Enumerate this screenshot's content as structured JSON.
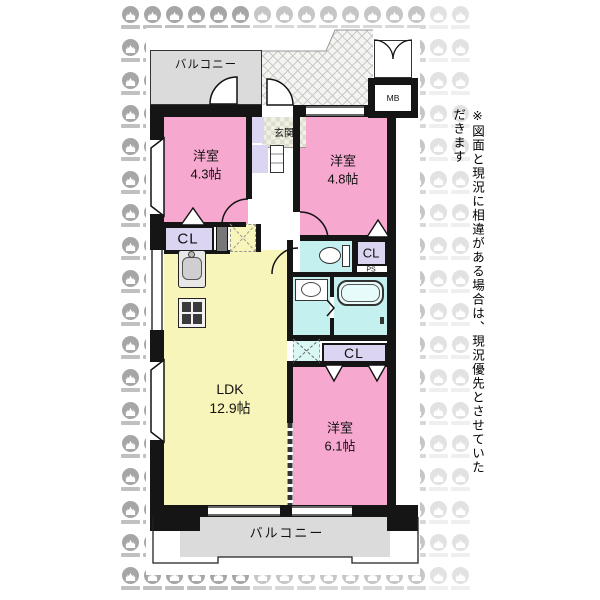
{
  "plan": {
    "balcony_top": "バルコニー",
    "balcony_bottom": "バルコニー",
    "entrance": "玄関",
    "meter_box": "MB",
    "pipe_space": "PS",
    "rooms": {
      "bedroom_4_3": {
        "name": "洋室",
        "size": "4.3帖"
      },
      "bedroom_4_8": {
        "name": "洋室",
        "size": "4.8帖"
      },
      "bedroom_6_1": {
        "name": "洋室",
        "size": "6.1帖"
      },
      "ldk": {
        "name": "LDK",
        "size": "12.9帖"
      }
    },
    "closets": {
      "cl1": "CL",
      "cl2": "CL",
      "cl3": "CL"
    }
  },
  "note": "※図面と現況に相違がある場合は、現況優先とさせていただきます",
  "colors": {
    "room_pink": "#F6A8CE",
    "ldk_yellow": "#F8F5BA",
    "closet_lavender": "#DBD5F2",
    "water_cyan": "#C4F1EF",
    "balcony_gray": "#DBDBDB",
    "wall_black": "#151515",
    "watermark_gray": "#C6C6C6"
  }
}
